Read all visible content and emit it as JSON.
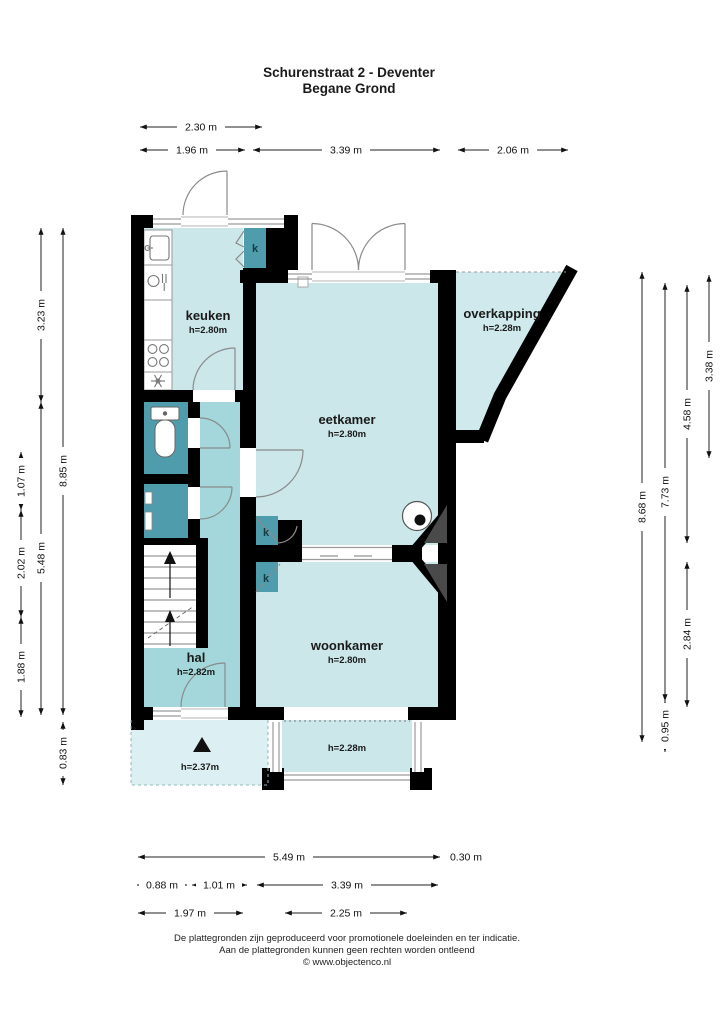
{
  "title": {
    "line1": "Schurenstraat 2 - Deventer",
    "line2": "Begane Grond"
  },
  "rooms": {
    "keuken": {
      "name": "keuken",
      "height": "h=2.80m"
    },
    "eetkamer": {
      "name": "eetkamer",
      "height": "h=2.80m"
    },
    "overkapping": {
      "name": "overkapping",
      "height": "h=2.28m"
    },
    "hal": {
      "name": "hal",
      "height": "h=2.82m"
    },
    "woonkamer": {
      "name": "woonkamer",
      "height": "h=2.80m"
    },
    "porch": {
      "height": "h=2.37m"
    },
    "bay": {
      "height": "h=2.28m"
    },
    "closet": {
      "label": "k"
    }
  },
  "dimensions": {
    "top": [
      "2.30 m",
      "1.96 m",
      "3.39 m",
      "2.06 m"
    ],
    "bottom": [
      "5.49 m",
      "0.30 m",
      "0.88 m",
      "1.01 m",
      "3.39 m",
      "1.97 m",
      "2.25 m"
    ],
    "left": [
      "3.23 m",
      "5.48 m",
      "8.85 m",
      "1.07 m",
      "2.02 m",
      "1.88 m",
      "0.83 m"
    ],
    "right": [
      "8.68 m",
      "7.73 m",
      "0.95 m",
      "4.58 m",
      "2.84 m",
      "3.38 m"
    ]
  },
  "footer": {
    "line1": "De plattegronden zijn geproduceerd voor promotionele doeleinden en ter indicatie.",
    "line2": "Aan de plattegronden kunnen geen rechten worden ontleend",
    "line3": "© www.objectenco.nl"
  },
  "colors": {
    "room_light": "#cbe7ea",
    "room_hal": "#a3d7db",
    "room_dark": "#4f9dac",
    "overkapping": "#cfe9ec",
    "porch": "#dcf0f3",
    "wall": "#000000",
    "chimney_gray": "#4a4a4a"
  }
}
